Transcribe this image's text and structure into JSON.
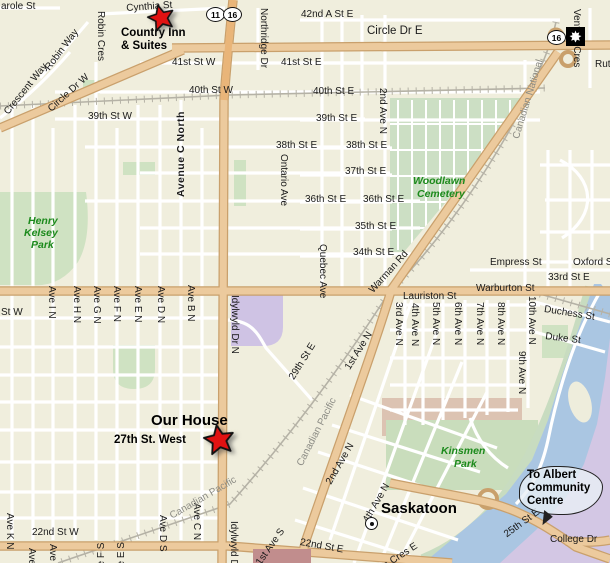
{
  "map": {
    "city": "Saskatoon",
    "markers": {
      "country_inn": {
        "line1": "Country Inn",
        "line2": "& Suites"
      },
      "our_house": {
        "label": "Our House",
        "street": "27th St. West"
      },
      "city_label": "Saskatoon"
    },
    "balloon": {
      "line1": "To Albert",
      "line2": "Community",
      "line3": "Centre"
    },
    "highway_shields": {
      "hwy11": "11",
      "hwy16": "16",
      "hwy16_e": "16",
      "maple_icon": "maple-leaf-icon"
    },
    "railways": [
      "Canadian National",
      "Canadian Pacific"
    ],
    "parks": [
      "Henry Kelsey Park",
      "Woodlawn Cemetery",
      "Kinsmen Park"
    ],
    "colors": {
      "background": "#f0eedd",
      "major_road": "#ecca9d",
      "road_casing": "#c9a06c",
      "freeway": "#e9b579",
      "river": "#aac6e2",
      "park": "#cfe2c2",
      "cemetery": "#ccdfc4",
      "campus": "#d3c7e4",
      "marker_red": "#e11212"
    },
    "street_labels": [
      {
        "t": "arole St",
        "x": 1,
        "y": 1
      },
      {
        "t": "Cynthia St",
        "x": 126,
        "y": 3,
        "r": -4
      },
      {
        "t": "42nd A St E",
        "x": 301,
        "y": 9
      },
      {
        "t": "Circle Dr E",
        "x": 367,
        "y": 26,
        "c": "md"
      },
      {
        "t": "41st St W",
        "x": 172,
        "y": 57
      },
      {
        "t": "41st St E",
        "x": 281,
        "y": 57
      },
      {
        "t": "40th St W",
        "x": 189,
        "y": 85
      },
      {
        "t": "40th St E",
        "x": 313,
        "y": 86
      },
      {
        "t": "39th St W",
        "x": 88,
        "y": 111
      },
      {
        "t": "39th St E",
        "x": 316,
        "y": 113
      },
      {
        "t": "38th St E",
        "x": 276,
        "y": 140
      },
      {
        "t": "38th St E",
        "x": 346,
        "y": 140
      },
      {
        "t": "37th St E",
        "x": 345,
        "y": 166
      },
      {
        "t": "36th St E",
        "x": 305,
        "y": 194
      },
      {
        "t": "36th St E",
        "x": 363,
        "y": 194
      },
      {
        "t": "35th St E",
        "x": 355,
        "y": 221
      },
      {
        "t": "34th St E",
        "x": 353,
        "y": 247
      },
      {
        "t": "Empress St",
        "x": 490,
        "y": 257
      },
      {
        "t": "Oxford St",
        "x": 573,
        "y": 257
      },
      {
        "t": "33rd St E",
        "x": 548,
        "y": 272
      },
      {
        "t": "St W",
        "x": 1,
        "y": 307
      },
      {
        "t": "Warburton St",
        "x": 476,
        "y": 283
      },
      {
        "t": "Lauriston St",
        "x": 403,
        "y": 291
      },
      {
        "t": "Duchess St",
        "x": 545,
        "y": 304,
        "r": 9
      },
      {
        "t": "Duke St",
        "x": 546,
        "y": 331,
        "r": 7
      },
      {
        "t": "22nd St W",
        "x": 32,
        "y": 527
      },
      {
        "t": "22nd St E",
        "x": 301,
        "y": 537,
        "r": 10
      },
      {
        "t": "College Dr",
        "x": 550,
        "y": 534
      },
      {
        "t": "Rut",
        "x": 595,
        "y": 59
      },
      {
        "t": "Northridge Dr",
        "x": 269,
        "y": 8,
        "r": 90
      },
      {
        "t": "Robin Cres",
        "x": 106,
        "y": 11,
        "r": 90
      },
      {
        "t": "Venture Cres",
        "x": 582,
        "y": 9,
        "r": 90
      },
      {
        "t": "2nd Ave N",
        "x": 388,
        "y": 88,
        "r": 90
      },
      {
        "t": "Ontario Ave",
        "x": 289,
        "y": 154,
        "r": 90
      },
      {
        "t": "Quebec Ave",
        "x": 328,
        "y": 244,
        "r": 90
      },
      {
        "t": "Ave I N",
        "x": 57,
        "y": 286,
        "r": 90
      },
      {
        "t": "Ave H N",
        "x": 82,
        "y": 286,
        "r": 90
      },
      {
        "t": "Ave G N",
        "x": 102,
        "y": 286,
        "r": 90
      },
      {
        "t": "Ave F N",
        "x": 122,
        "y": 286,
        "r": 90
      },
      {
        "t": "Ave E N",
        "x": 143,
        "y": 286,
        "r": 90
      },
      {
        "t": "Ave D N",
        "x": 166,
        "y": 286,
        "r": 90
      },
      {
        "t": "Ave B N",
        "x": 196,
        "y": 285,
        "r": 90
      },
      {
        "t": "Idylwyld Dr N",
        "x": 240,
        "y": 295,
        "r": 90
      },
      {
        "t": "3rd Ave N",
        "x": 404,
        "y": 302,
        "r": 90
      },
      {
        "t": "4th Ave N",
        "x": 420,
        "y": 303,
        "r": 90
      },
      {
        "t": "5th Ave N",
        "x": 441,
        "y": 302,
        "r": 90
      },
      {
        "t": "6th Ave N",
        "x": 463,
        "y": 302,
        "r": 90
      },
      {
        "t": "7th Ave N",
        "x": 485,
        "y": 302,
        "r": 90
      },
      {
        "t": "8th Ave N",
        "x": 506,
        "y": 302,
        "r": 90
      },
      {
        "t": "10th Ave N",
        "x": 537,
        "y": 296,
        "r": 90
      },
      {
        "t": "9th Ave N",
        "x": 527,
        "y": 351,
        "r": 90
      },
      {
        "t": "Ave K N",
        "x": 15,
        "y": 513,
        "r": 90
      },
      {
        "t": "Ave C N",
        "x": 202,
        "y": 503,
        "r": 90
      },
      {
        "t": "Idylwyld Dr N",
        "x": 239,
        "y": 521,
        "r": 90
      },
      {
        "t": "Ave D S",
        "x": 168,
        "y": 515,
        "r": 90
      },
      {
        "t": "Ave",
        "x": 37,
        "y": 548,
        "r": 90
      },
      {
        "t": "Ave",
        "x": 58,
        "y": 544,
        "r": 90
      },
      {
        "t": "Ave F S",
        "x": 96,
        "y": 578,
        "r": -90
      },
      {
        "t": "Ave E S",
        "x": 116,
        "y": 578,
        "r": -90
      },
      {
        "t": "Avenue C North",
        "x": 176,
        "y": 197,
        "r": -90,
        "c": "b"
      },
      {
        "t": "Crescent Way",
        "x": 2,
        "y": 110,
        "r": -51
      },
      {
        "t": "Robin Way",
        "x": 43,
        "y": 66,
        "r": -53
      },
      {
        "t": "Circle Dr W",
        "x": 46,
        "y": 106,
        "r": -42
      },
      {
        "t": "Canadian National",
        "x": 511,
        "y": 137,
        "r": -73,
        "c": "rr"
      },
      {
        "t": "Warman Rd",
        "x": 367,
        "y": 288,
        "r": -48
      },
      {
        "t": "1st Ave N",
        "x": 343,
        "y": 366,
        "r": -58
      },
      {
        "t": "29th St E",
        "x": 287,
        "y": 376,
        "r": -58
      },
      {
        "t": "Canadian Pacific",
        "x": 295,
        "y": 463,
        "r": -63,
        "c": "rr"
      },
      {
        "t": "Canadian Pacific",
        "x": 168,
        "y": 512,
        "r": -30,
        "c": "rr"
      },
      {
        "t": "2nd Ave N",
        "x": 324,
        "y": 481,
        "r": -60
      },
      {
        "t": "4th Ave N",
        "x": 361,
        "y": 519,
        "r": -60
      },
      {
        "t": "25th St E",
        "x": 502,
        "y": 531,
        "r": -36
      },
      {
        "t": "1st Ave S",
        "x": 254,
        "y": 561,
        "r": -55
      },
      {
        "t": "a Cres E",
        "x": 381,
        "y": 562,
        "r": -33
      },
      {
        "t": "Henry",
        "x": 28,
        "y": 216,
        "c": "pk"
      },
      {
        "t": "Kelsey",
        "x": 24,
        "y": 228,
        "c": "pk"
      },
      {
        "t": "Park",
        "x": 31,
        "y": 240,
        "c": "pk"
      },
      {
        "t": "Woodlawn",
        "x": 413,
        "y": 176,
        "c": "pk"
      },
      {
        "t": "Cemetery",
        "x": 417,
        "y": 189,
        "c": "pk"
      },
      {
        "t": "Kinsmen",
        "x": 441,
        "y": 446,
        "c": "pk"
      },
      {
        "t": "Park",
        "x": 454,
        "y": 459,
        "c": "pk"
      }
    ]
  }
}
